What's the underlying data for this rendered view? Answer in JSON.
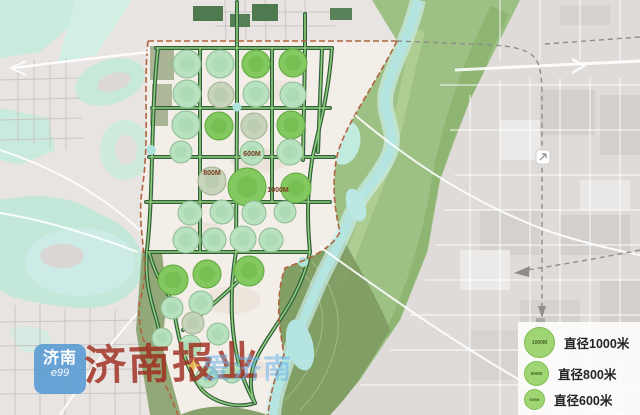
{
  "map": {
    "region_labels": [
      {
        "text": "600M",
        "x": 252,
        "y": 156
      },
      {
        "text": "800M",
        "x": 212,
        "y": 175
      },
      {
        "text": "1000M",
        "x": 278,
        "y": 192
      }
    ],
    "circles": [
      {
        "x": 187,
        "y": 64,
        "r": 14,
        "tone": "pale"
      },
      {
        "x": 220,
        "y": 64,
        "r": 14,
        "tone": "pale"
      },
      {
        "x": 256,
        "y": 64,
        "r": 14,
        "tone": "bright"
      },
      {
        "x": 293,
        "y": 63,
        "r": 14,
        "tone": "bright"
      },
      {
        "x": 187,
        "y": 94,
        "r": 14,
        "tone": "pale"
      },
      {
        "x": 221,
        "y": 95,
        "r": 13,
        "tone": "sage"
      },
      {
        "x": 256,
        "y": 94,
        "r": 13,
        "tone": "pale"
      },
      {
        "x": 293,
        "y": 95,
        "r": 13,
        "tone": "pale"
      },
      {
        "x": 186,
        "y": 125,
        "r": 14,
        "tone": "pale"
      },
      {
        "x": 219,
        "y": 126,
        "r": 14,
        "tone": "bright"
      },
      {
        "x": 254,
        "y": 126,
        "r": 13,
        "tone": "sage"
      },
      {
        "x": 291,
        "y": 125,
        "r": 14,
        "tone": "bright"
      },
      {
        "x": 181,
        "y": 152,
        "r": 11,
        "tone": "pale"
      },
      {
        "x": 252,
        "y": 153,
        "r": 12,
        "tone": "pale"
      },
      {
        "x": 290,
        "y": 152,
        "r": 13,
        "tone": "pale"
      },
      {
        "x": 212,
        "y": 181,
        "r": 14,
        "tone": "sage"
      },
      {
        "x": 247,
        "y": 187,
        "r": 19,
        "tone": "bright"
      },
      {
        "x": 296,
        "y": 188,
        "r": 15,
        "tone": "bright"
      },
      {
        "x": 190,
        "y": 213,
        "r": 12,
        "tone": "pale"
      },
      {
        "x": 222,
        "y": 212,
        "r": 12,
        "tone": "pale"
      },
      {
        "x": 254,
        "y": 213,
        "r": 12,
        "tone": "pale"
      },
      {
        "x": 285,
        "y": 212,
        "r": 11,
        "tone": "pale"
      },
      {
        "x": 186,
        "y": 240,
        "r": 13,
        "tone": "pale"
      },
      {
        "x": 214,
        "y": 240,
        "r": 12,
        "tone": "pale"
      },
      {
        "x": 243,
        "y": 239,
        "r": 13,
        "tone": "pale"
      },
      {
        "x": 271,
        "y": 240,
        "r": 12,
        "tone": "pale"
      },
      {
        "x": 173,
        "y": 280,
        "r": 15,
        "tone": "bright"
      },
      {
        "x": 207,
        "y": 274,
        "r": 14,
        "tone": "bright"
      },
      {
        "x": 249,
        "y": 271,
        "r": 15,
        "tone": "bright"
      },
      {
        "x": 172,
        "y": 308,
        "r": 11,
        "tone": "pale"
      },
      {
        "x": 201,
        "y": 303,
        "r": 12,
        "tone": "pale"
      },
      {
        "x": 193,
        "y": 323,
        "r": 11,
        "tone": "sage"
      },
      {
        "x": 218,
        "y": 334,
        "r": 11,
        "tone": "pale"
      },
      {
        "x": 162,
        "y": 338,
        "r": 10,
        "tone": "pale"
      },
      {
        "x": 190,
        "y": 346,
        "r": 11,
        "tone": "pale"
      },
      {
        "x": 207,
        "y": 377,
        "r": 11,
        "tone": "pale"
      },
      {
        "x": 232,
        "y": 373,
        "r": 10,
        "tone": "pale"
      }
    ]
  },
  "legend": {
    "items": [
      {
        "symbol": "1000M",
        "label": "直径1000米"
      },
      {
        "symbol": "800M",
        "label": "直径800米"
      },
      {
        "symbol": "600M",
        "label": "直径600米"
      }
    ]
  },
  "watermarks": {
    "logo_line1": "济南",
    "logo_line2": "e99",
    "press": "济南报业",
    "city_sparkle": "✦",
    "city": "爱济南"
  },
  "colors": {
    "circle_bright": "#83c95f",
    "circle_pale": "#b7e1bf",
    "circle_sage": "#c5d4ba",
    "corridor_dark": "#2f5f3d",
    "corridor_light": "#90cc79",
    "boundary": "#b06443",
    "label_red": "#7c3a20",
    "legend_green": "#9fd573",
    "river": "#b4e5e0",
    "band_green": "#9dc084",
    "olive": "#7f9c64",
    "planning_bg": "#f3efe8"
  }
}
